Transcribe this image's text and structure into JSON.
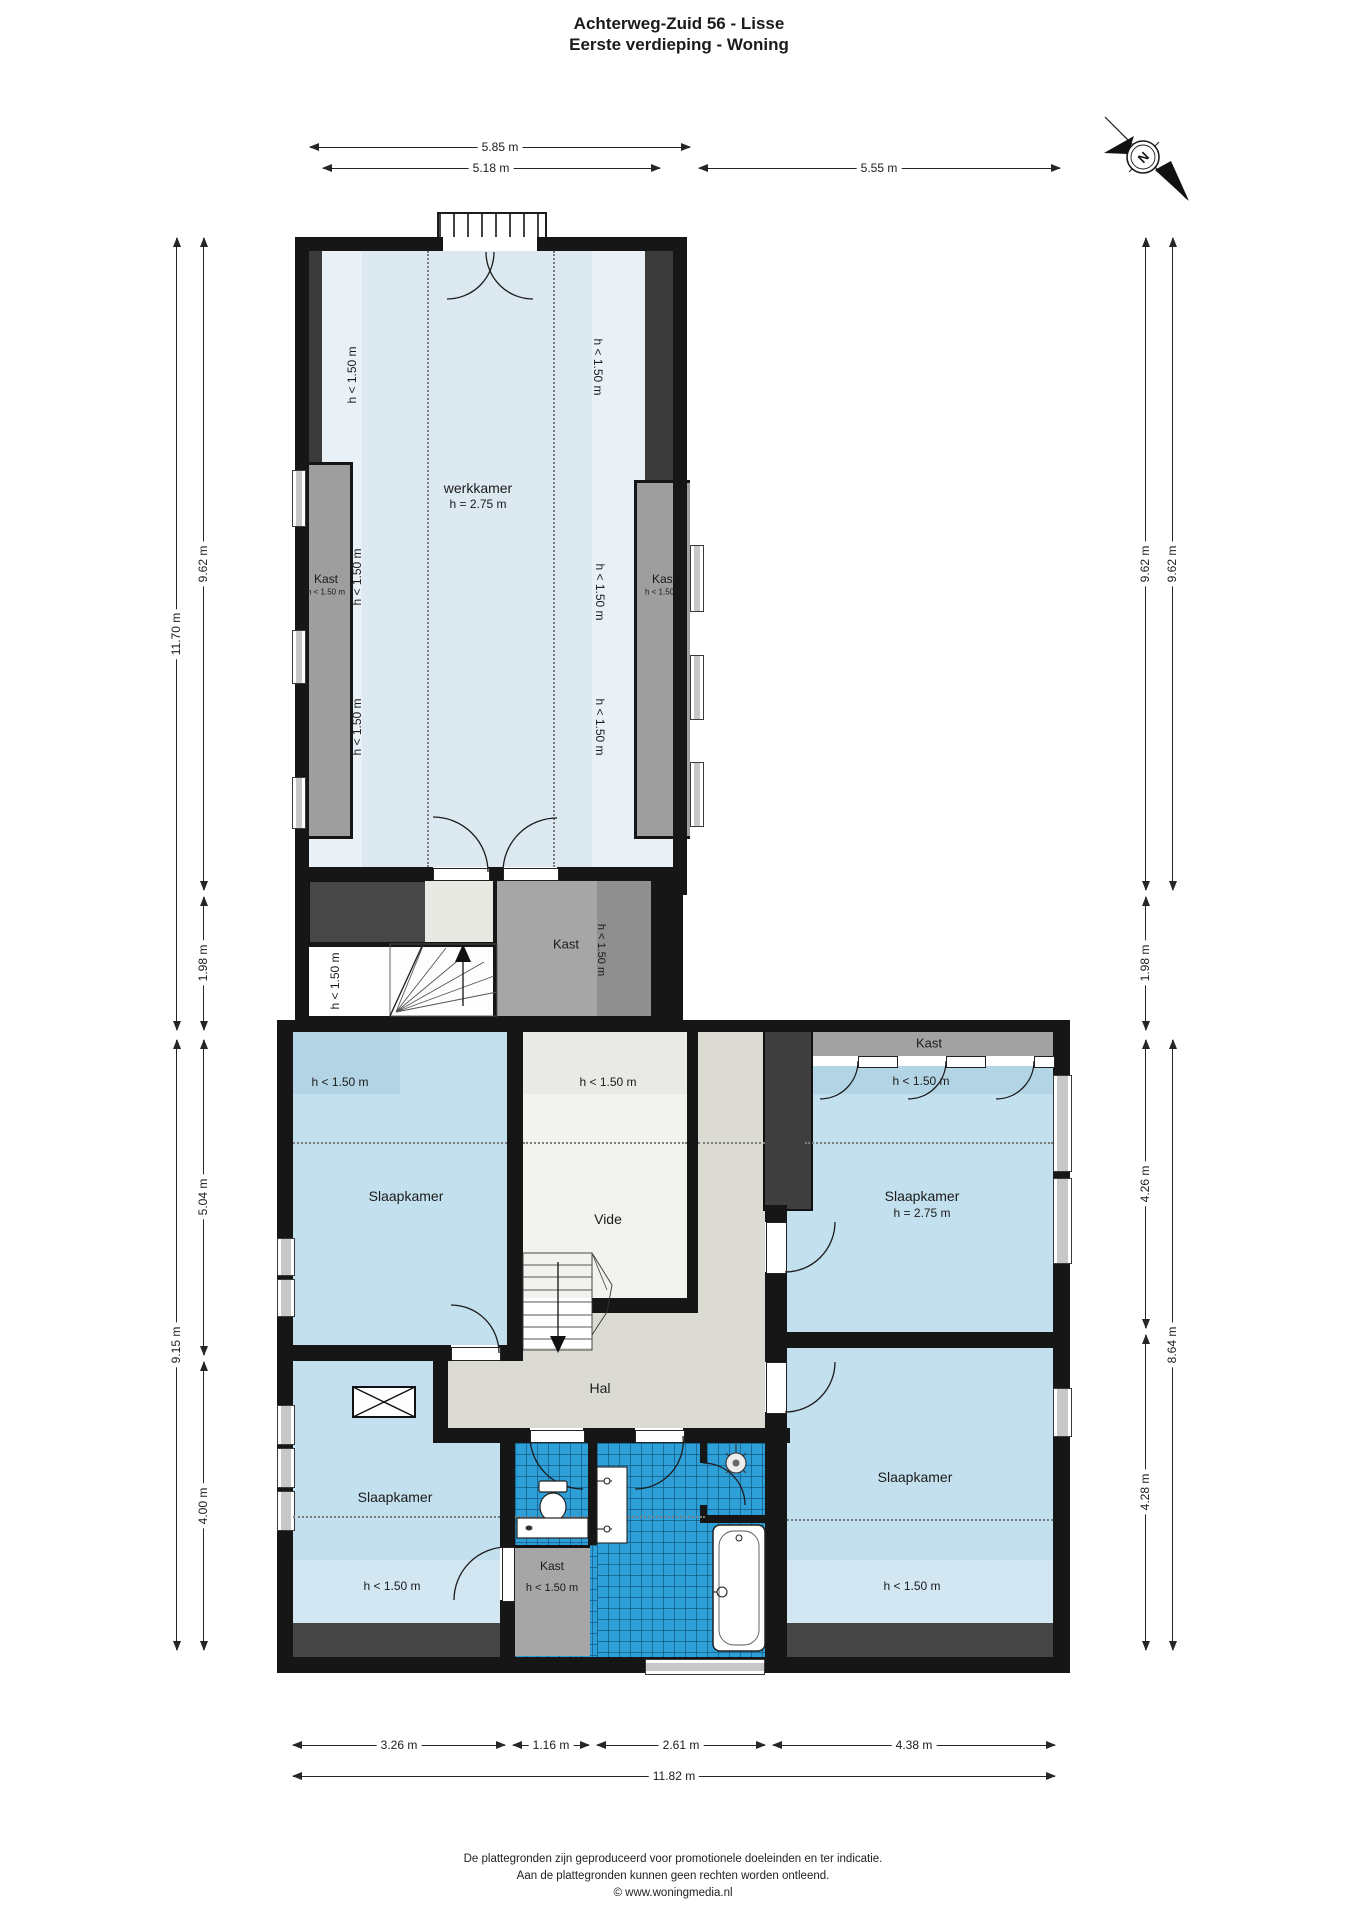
{
  "title": {
    "line1": "Achterweg-Zuid 56 - Lisse",
    "line2": "Eerste verdieping - Woning"
  },
  "compass": {
    "north_label": "N"
  },
  "rooms": {
    "werkkamer": "werkkamer",
    "werkkamer_height": "h = 2.75 m",
    "slaapkamer": "Slaapkamer",
    "slaapkamer_height": "h = 2.75 m",
    "vide": "Vide",
    "hal": "Hal",
    "kast": "Kast"
  },
  "annotations": {
    "low_clearance": "h < 1.50 m"
  },
  "dimensions": {
    "top": {
      "outer_width": "5.85 m",
      "inner_width": "5.18 m",
      "right_width": "5.55 m"
    },
    "left": {
      "total_height": "11.70 m",
      "upper": "9.62 m",
      "mid": "1.98 m",
      "lower_total": "9.15 m",
      "lower_upper": "5.04 m",
      "lower_bottom": "4.00 m"
    },
    "right": {
      "upper_inner": "9.62 m",
      "upper_outer": "9.62 m",
      "mid": "1.98 m",
      "bedroom_upper": "4.26 m",
      "bedroom_lower": "4.28 m",
      "lower_total": "8.64 m"
    },
    "bottom": {
      "seg1": "3.26 m",
      "seg2": "1.16 m",
      "seg3": "2.61 m",
      "seg4": "4.38 m",
      "total": "11.82 m"
    }
  },
  "footer": {
    "line1": "De plattegronden zijn geproduceerd voor promotionele doeleinden en ter indicatie.",
    "line2": "Aan de plattegronden kunnen geen rechten worden ontleend.",
    "line3": "© www.woningmedia.nl"
  }
}
